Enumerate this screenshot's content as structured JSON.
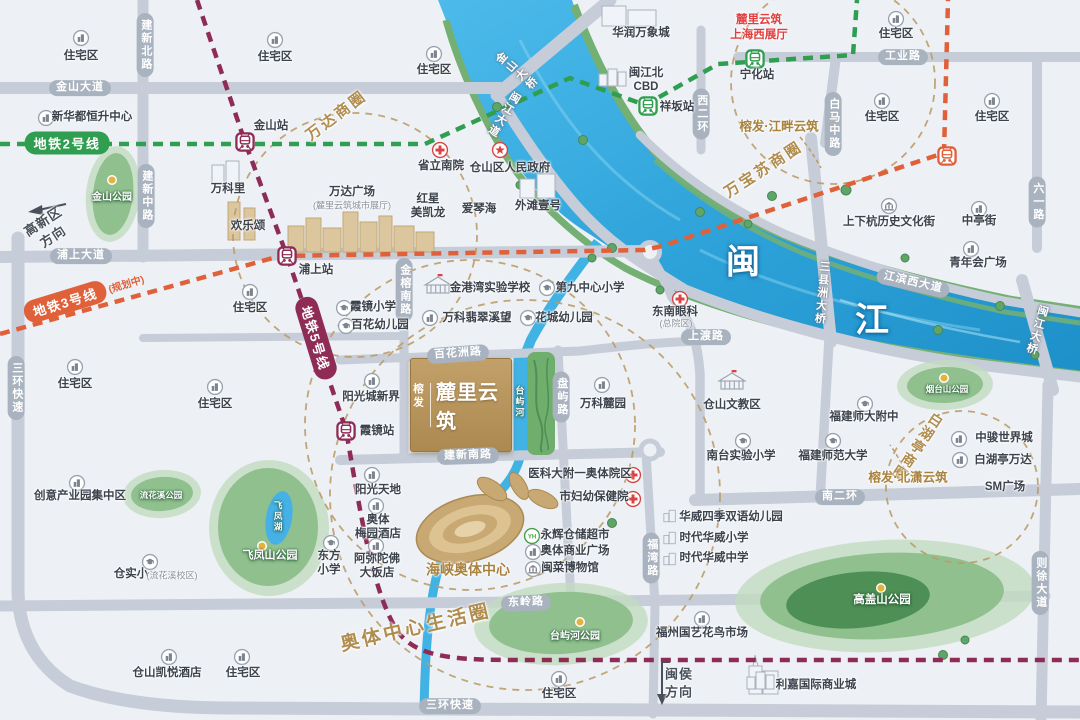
{
  "project": {
    "brand": "榕发",
    "name": "麓里云筑"
  },
  "river": {
    "name": "闽江",
    "chars": [
      {
        "t": "闽",
        "x": 743,
        "y": 264
      },
      {
        "t": "江",
        "x": 872,
        "y": 322
      }
    ],
    "tributary": {
      "t": "台屿河",
      "x": 519,
      "y": 402
    },
    "lake": {
      "t": "飞凤湖",
      "x": 278,
      "y": 517
    }
  },
  "metro": {
    "lines": [
      {
        "id": "2",
        "color": "#2f9e50",
        "pill": {
          "t": "地铁2号线",
          "x": 67,
          "y": 143,
          "r": 0
        },
        "stations": [
          {
            "n": "祥坂站",
            "x": 648,
            "y": 106,
            "lx": 677,
            "ly": 108
          },
          {
            "n": "宁化站",
            "x": 755,
            "y": 59,
            "lx": 757,
            "ly": 76
          }
        ]
      },
      {
        "id": "3",
        "color": "#e0603a",
        "pill": {
          "t": "地铁3号线",
          "suf": "(规划中)",
          "x": 84,
          "y": 296,
          "r": -17
        },
        "stations": [
          {
            "n": "",
            "x": 947,
            "y": 156
          }
        ]
      },
      {
        "id": "5",
        "color": "#8e2c55",
        "pill": {
          "t": "地铁5号线",
          "x": 316,
          "y": 338,
          "r": 73
        },
        "stations": [
          {
            "n": "金山站",
            "x": 245,
            "y": 142,
            "lx": 271,
            "ly": 127
          },
          {
            "n": "浦上站",
            "x": 287,
            "y": 256,
            "lx": 316,
            "ly": 271
          },
          {
            "n": "霞镜站",
            "x": 346,
            "y": 431,
            "lx": 377,
            "ly": 432
          }
        ]
      }
    ]
  },
  "roads": [
    {
      "t": "金山大道",
      "x": 80,
      "y": 88
    },
    {
      "t": "建新北路",
      "x": 145,
      "y": 45,
      "v": true
    },
    {
      "t": "建新中路",
      "x": 146,
      "y": 196,
      "v": true
    },
    {
      "t": "浦上大道",
      "x": 81,
      "y": 256
    },
    {
      "t": "三环快速",
      "x": 16,
      "y": 388,
      "v": true
    },
    {
      "t": "三环快速",
      "x": 450,
      "y": 706
    },
    {
      "t": "工业路",
      "x": 903,
      "y": 57
    },
    {
      "t": "西二环",
      "x": 701,
      "y": 114,
      "v": true
    },
    {
      "t": "白马中路",
      "x": 833,
      "y": 124,
      "v": true
    },
    {
      "t": "六一路",
      "x": 1037,
      "y": 202,
      "v": true
    },
    {
      "t": "金榕南路",
      "x": 404,
      "y": 290,
      "v": true
    },
    {
      "t": "百花洲路",
      "x": 458,
      "y": 354,
      "r": -4
    },
    {
      "t": "盘屿路",
      "x": 561,
      "y": 397,
      "v": true
    },
    {
      "t": "建新南路",
      "x": 468,
      "y": 456,
      "r": -2
    },
    {
      "t": "上渡路",
      "x": 706,
      "y": 337
    },
    {
      "t": "南二环",
      "x": 840,
      "y": 497
    },
    {
      "t": "东岭路",
      "x": 526,
      "y": 603,
      "r": -2
    },
    {
      "t": "福湾路",
      "x": 651,
      "y": 558,
      "v": true
    },
    {
      "t": "则徐大道",
      "x": 1040,
      "y": 583,
      "v": true
    },
    {
      "t": "江滨西大道",
      "x": 913,
      "y": 283,
      "r": 13
    },
    {
      "t": "闽江大道",
      "x": 503,
      "y": 114,
      "v": true,
      "r": 32,
      "rt": true
    },
    {
      "t": "金山大桥",
      "x": 516,
      "y": 72,
      "v": true,
      "r": -50,
      "rt": true
    },
    {
      "t": "三县洲大桥",
      "x": 821,
      "y": 293,
      "v": true,
      "r": 5,
      "rt": true
    },
    {
      "t": "闽江大桥",
      "x": 1036,
      "y": 330,
      "v": true,
      "r": 16,
      "rt": true
    }
  ],
  "business_circles": [
    {
      "name": "万达商圈",
      "cx": 355,
      "cy": 235,
      "r": 122,
      "lx": 337,
      "ly": 116,
      "rot": -37,
      "fs": 15
    },
    {
      "name": "万宝苏商圈",
      "cx": 833,
      "cy": 82,
      "r": 102,
      "lx": 764,
      "ly": 170,
      "rot": -33,
      "fs": 15
    },
    {
      "name": "白湖亭商圈",
      "cx": 962,
      "cy": 487,
      "r": 76,
      "lx": 917,
      "ly": 447,
      "rot": 34,
      "fs": 14,
      "v": true
    },
    {
      "name": "",
      "cx": 470,
      "cy": 425,
      "r": 165
    },
    {
      "name": "奥体中心生活圈",
      "cx": 525,
      "cy": 495,
      "r": 195,
      "lx": 416,
      "ly": 629,
      "rot": -13,
      "fs": 19
    }
  ],
  "parks": [
    {
      "name": "金山公园",
      "lx": 112,
      "ly": 198,
      "fs": 10,
      "dot": [
        112,
        180
      ],
      "o": [
        113,
        194,
        27,
        48,
        6
      ],
      "m": [
        113,
        194,
        20,
        41,
        6
      ]
    },
    {
      "name": "流花溪公园",
      "lx": 161,
      "ly": 495,
      "fs": 8.5,
      "o": [
        162,
        494,
        39,
        24,
        -4
      ],
      "m": [
        162,
        494,
        31,
        17,
        -4
      ]
    },
    {
      "name": "飞凤山公园",
      "lx": 270,
      "ly": 556,
      "fs": 11,
      "dot": [
        262,
        546
      ],
      "o": [
        269,
        528,
        60,
        68,
        0
      ],
      "m": [
        268,
        527,
        50,
        59,
        0
      ],
      "lake": [
        279,
        518,
        13,
        27,
        10
      ]
    },
    {
      "name": "台屿河公园",
      "lx": 575,
      "ly": 637,
      "fs": 10,
      "dot": [
        580,
        622
      ],
      "o": [
        561,
        624,
        87,
        41,
        -3
      ],
      "m": [
        561,
        623,
        72,
        31,
        -3
      ]
    },
    {
      "name": "烟台山公园",
      "lx": 947,
      "ly": 389,
      "fs": 8.5,
      "dot": [
        944,
        378
      ],
      "o": [
        945,
        385,
        48,
        25,
        -2
      ],
      "m": [
        945,
        385,
        38,
        18,
        -2
      ]
    },
    {
      "name": "高盖山公园",
      "lx": 882,
      "ly": 601,
      "fs": 11.5,
      "dot": [
        881,
        588
      ],
      "o": [
        885,
        596,
        150,
        56,
        -3
      ],
      "m": [
        882,
        596,
        122,
        43,
        -3
      ],
      "c": [
        858,
        600,
        72,
        28,
        -5
      ]
    }
  ],
  "pois": [
    {
      "i": "building",
      "t": "住宅区",
      "ix": 81,
      "iy": 38,
      "lx": 81,
      "ly": 57
    },
    {
      "i": "building",
      "t": "住宅区",
      "ix": 275,
      "iy": 40,
      "lx": 275,
      "ly": 58
    },
    {
      "i": "building",
      "t": "住宅区",
      "ix": 434,
      "iy": 54,
      "lx": 434,
      "ly": 71
    },
    {
      "i": "building",
      "t": "住宅区",
      "ix": 896,
      "iy": 19,
      "lx": 896,
      "ly": 35
    },
    {
      "i": "building",
      "t": "住宅区",
      "ix": 882,
      "iy": 101,
      "lx": 882,
      "ly": 118
    },
    {
      "i": "building",
      "t": "住宅区",
      "ix": 992,
      "iy": 101,
      "lx": 992,
      "ly": 118
    },
    {
      "i": "building",
      "t": "住宅区",
      "ix": 250,
      "iy": 292,
      "lx": 250,
      "ly": 309
    },
    {
      "i": "building",
      "t": "住宅区",
      "ix": 75,
      "iy": 367,
      "lx": 75,
      "ly": 385
    },
    {
      "i": "building",
      "t": "住宅区",
      "ix": 215,
      "iy": 387,
      "lx": 215,
      "ly": 405
    },
    {
      "i": "building",
      "t": "住宅区",
      "ix": 242,
      "iy": 657,
      "lx": 243,
      "ly": 674
    },
    {
      "i": "building",
      "t": "住宅区",
      "ix": 559,
      "iy": 679,
      "lx": 559,
      "ly": 695
    },
    {
      "i": "building",
      "t": "新华都恒升中心",
      "ix": 46,
      "iy": 118,
      "lx": 92,
      "ly": 118
    },
    {
      "t": "万科里",
      "lx": 228,
      "ly": 190
    },
    {
      "t": "欢乐颂",
      "lx": 248,
      "ly": 227
    },
    {
      "t": "万达广场",
      "lx": 352,
      "ly": 193,
      "st": "(麓里云筑城市展厅)",
      "sx": 352,
      "sy": 206
    },
    {
      "i": "hospital",
      "t": "省立南院",
      "ix": 440,
      "iy": 150,
      "lx": 441,
      "ly": 167
    },
    {
      "i": "gov",
      "t": "仓山区人民政府",
      "ix": 500,
      "iy": 150,
      "lx": 510,
      "ly": 169
    },
    {
      "t": "红星\n美凯龙",
      "lx": 428,
      "ly": 207
    },
    {
      "t": "爱琴海",
      "lx": 479,
      "ly": 210
    },
    {
      "t": "外滩壹号",
      "lx": 538,
      "ly": 207
    },
    {
      "t": "华润万象城",
      "lx": 641,
      "ly": 34
    },
    {
      "i": "bigsketch",
      "t": "闽江北\nCBD",
      "ix": 614,
      "iy": 77,
      "lx": 646,
      "ly": 81
    },
    {
      "i": "school",
      "t": "霞镜小学",
      "ix": 344,
      "iy": 308,
      "lx": 373,
      "ly": 308
    },
    {
      "i": "school",
      "t": "百花幼儿园",
      "ix": 346,
      "iy": 326,
      "lx": 380,
      "ly": 326
    },
    {
      "i": "institution",
      "t": "金港湾实验学校",
      "ix": 438,
      "iy": 285,
      "lx": 490,
      "ly": 289
    },
    {
      "i": "school",
      "t": "第九中心小学",
      "ix": 547,
      "iy": 288,
      "lx": 590,
      "ly": 289
    },
    {
      "i": "building",
      "t": "万科翡翠溪望",
      "ix": 430,
      "iy": 318,
      "lx": 477,
      "ly": 319
    },
    {
      "i": "school",
      "t": "花城幼儿园",
      "ix": 528,
      "iy": 318,
      "lx": 564,
      "ly": 319
    },
    {
      "i": "hospital",
      "t": "东南眼科",
      "ix": 680,
      "iy": 299,
      "lx": 675,
      "ly": 313,
      "st": "(总院区)",
      "sx": 676,
      "sy": 324
    },
    {
      "i": "building",
      "t": "万科麓园",
      "ix": 602,
      "iy": 385,
      "lx": 603,
      "ly": 405
    },
    {
      "i": "institution",
      "t": "仓山文教区",
      "ix": 732,
      "iy": 381,
      "lx": 732,
      "ly": 406
    },
    {
      "i": "hospital",
      "t": "医科大附一奥体院区",
      "ix": 633,
      "iy": 475,
      "lx": 580,
      "ly": 475
    },
    {
      "i": "hospital",
      "t": "市妇幼保健院",
      "ix": 633,
      "iy": 499,
      "lx": 594,
      "ly": 498
    },
    {
      "i": "building",
      "t": "阳光城新界",
      "ix": 372,
      "iy": 381,
      "lx": 371,
      "ly": 398
    },
    {
      "i": "building",
      "t": "阳光天地",
      "ix": 372,
      "iy": 475,
      "lx": 378,
      "ly": 491
    },
    {
      "i": "building",
      "t": "奥体\n梅园酒店",
      "ix": 376,
      "iy": 506,
      "lx": 378,
      "ly": 528
    },
    {
      "i": "building",
      "t": "阿弥陀佛\n大饭店",
      "ix": 376,
      "iy": 546,
      "lx": 377,
      "ly": 567
    },
    {
      "i": "yh",
      "t": "永辉仓储超市",
      "ix": 532,
      "iy": 536,
      "lx": 575,
      "ly": 536
    },
    {
      "i": "building",
      "t": "奥体商业广场",
      "ix": 533,
      "iy": 552,
      "lx": 575,
      "ly": 552
    },
    {
      "i": "museum",
      "t": "闽菜博物馆",
      "ix": 533,
      "iy": 569,
      "lx": 570,
      "ly": 569
    },
    {
      "i": "school",
      "t": "东方\n小学",
      "ix": 331,
      "iy": 543,
      "lx": 329,
      "ly": 564
    },
    {
      "i": "school",
      "t": "仓实小",
      "ix": 150,
      "iy": 562,
      "lx": 131,
      "ly": 575,
      "st": "(流花溪校区)",
      "sx": 172,
      "sy": 576
    },
    {
      "i": "building",
      "t": "创意产业园集中区",
      "ix": 77,
      "iy": 483,
      "lx": 80,
      "ly": 497
    },
    {
      "i": "building",
      "t": "仓山凯悦酒店",
      "ix": 169,
      "iy": 657,
      "lx": 167,
      "ly": 674
    },
    {
      "i": "school",
      "t": "福建师大附中",
      "ix": 865,
      "iy": 404,
      "lx": 864,
      "ly": 418
    },
    {
      "i": "school",
      "t": "南台实验小学",
      "ix": 743,
      "iy": 441,
      "lx": 741,
      "ly": 457
    },
    {
      "i": "school",
      "t": "福建师范大学",
      "ix": 833,
      "iy": 441,
      "lx": 833,
      "ly": 457
    },
    {
      "i": "building",
      "t": "青年会广场",
      "ix": 971,
      "iy": 249,
      "lx": 978,
      "ly": 264
    },
    {
      "i": "museum",
      "t": "上下杭历史文化街",
      "ix": 889,
      "iy": 206,
      "lx": 889,
      "ly": 223
    },
    {
      "i": "building",
      "t": "中亭街",
      "ix": 979,
      "iy": 209,
      "lx": 979,
      "ly": 222
    },
    {
      "i": "building",
      "t": "中骏世界城",
      "ix": 959,
      "iy": 439,
      "lx": 1004,
      "ly": 439
    },
    {
      "i": "building",
      "t": "白湖亭万达",
      "ix": 960,
      "iy": 460,
      "lx": 1003,
      "ly": 461
    },
    {
      "t": "SM广场",
      "lx": 1005,
      "ly": 488
    },
    {
      "i": "sketch",
      "t": "华威四季双语幼儿园",
      "ix": 670,
      "iy": 516,
      "lx": 731,
      "ly": 518
    },
    {
      "i": "sketch",
      "t": "时代华威小学",
      "ix": 670,
      "iy": 538,
      "lx": 714,
      "ly": 539
    },
    {
      "i": "sketch",
      "t": "时代华威中学",
      "ix": 670,
      "iy": 559,
      "lx": 714,
      "ly": 559
    },
    {
      "i": "building",
      "t": "福州国艺花鸟市场",
      "ix": 702,
      "iy": 619,
      "lx": 702,
      "ly": 634
    },
    {
      "i": "bigsketch",
      "t": "利嘉国际商业城",
      "ix": 762,
      "iy": 680,
      "lx": 816,
      "ly": 686
    },
    {
      "t": "麓里云筑\n上海西展厅",
      "lx": 759,
      "ly": 28,
      "c": "red"
    },
    {
      "t": "榕发·江畔云筑",
      "lx": 779,
      "ly": 127,
      "c": "gold"
    },
    {
      "t": "榕发·北潇云筑",
      "lx": 908,
      "ly": 478,
      "c": "gold"
    },
    {
      "t": "海峡奥体中心",
      "lx": 468,
      "ly": 570,
      "c": "gold",
      "fs": 14
    }
  ],
  "directions": [
    {
      "t": "高新区\n方向",
      "x": 48,
      "y": 229,
      "r": -33
    },
    {
      "t": "闽侯\n方向",
      "x": 679,
      "y": 683,
      "r": 0
    }
  ],
  "colors": {
    "water": "#3fb0e2",
    "road": "#c6cdd8",
    "road_pill": "#a9b2bf",
    "bank_green": "#74b073",
    "park_outer": "#c2dcc0",
    "park_mid": "#8fc08e",
    "park_core": "#4e8f55",
    "line2": "#2f9e50",
    "line3": "#e0603a",
    "line5": "#8e2c55",
    "gold": "#b08c4e",
    "circle_dash": "#bb9c68",
    "hospital_red": "#d84343",
    "project_gold": "#b29259"
  }
}
